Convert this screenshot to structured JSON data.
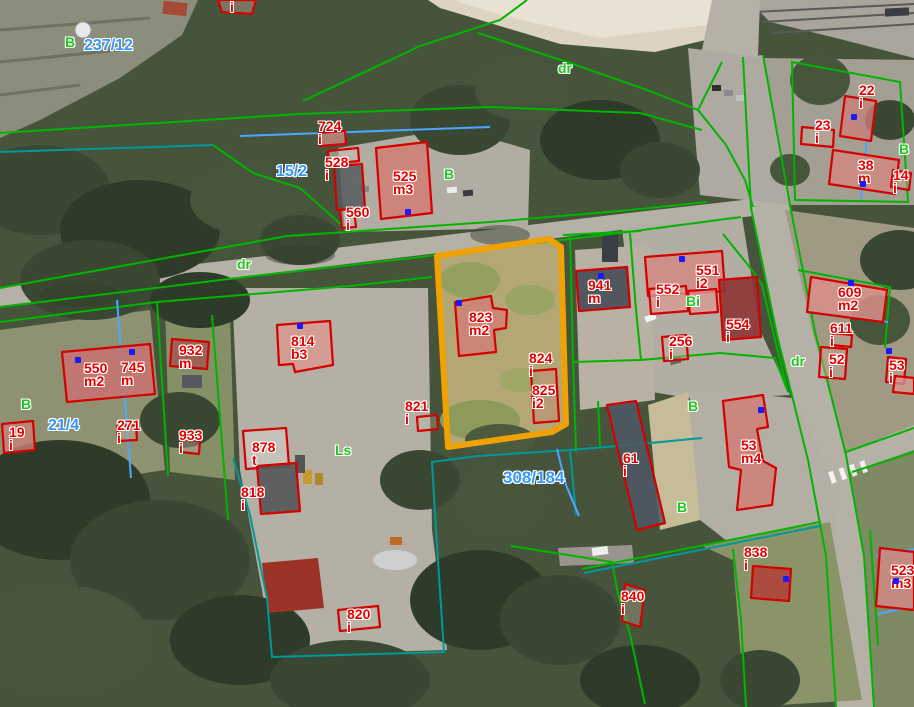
{
  "map": {
    "type": "aerial-cadastral-map",
    "colors": {
      "parcel_line_green": "#00b400",
      "parcel_line_teal": "#009898",
      "parcel_line_blue": "#4da6ff",
      "building_outline_red": "#d40000",
      "highlight_parcel_orange": "#f0a202",
      "label_red": "#e60000",
      "label_green": "#1fc71f",
      "label_blue": "#3399ff",
      "address_point_blue": "#1a1aff"
    },
    "labels": [
      {
        "lines": [
          "i"
        ],
        "x": 230,
        "y": 1,
        "color": "red"
      },
      {
        "lines": [
          "724",
          "i"
        ],
        "x": 318,
        "y": 120,
        "color": "red"
      },
      {
        "lines": [
          "528",
          "i"
        ],
        "x": 325,
        "y": 156,
        "color": "red"
      },
      {
        "lines": [
          "525",
          "m3"
        ],
        "x": 393,
        "y": 170,
        "color": "red"
      },
      {
        "lines": [
          "560",
          "i"
        ],
        "x": 346,
        "y": 206,
        "color": "red"
      },
      {
        "lines": [
          "823",
          "m2"
        ],
        "x": 469,
        "y": 311,
        "color": "red"
      },
      {
        "lines": [
          "824",
          "i"
        ],
        "x": 529,
        "y": 352,
        "color": "red"
      },
      {
        "lines": [
          "825",
          "i2"
        ],
        "x": 532,
        "y": 384,
        "color": "red"
      },
      {
        "lines": [
          "941",
          "m"
        ],
        "x": 588,
        "y": 279,
        "color": "red"
      },
      {
        "lines": [
          "551",
          "i2"
        ],
        "x": 696,
        "y": 264,
        "color": "red"
      },
      {
        "lines": [
          "552",
          "i"
        ],
        "x": 656,
        "y": 283,
        "color": "red"
      },
      {
        "lines": [
          "554",
          "i"
        ],
        "x": 726,
        "y": 318,
        "color": "red"
      },
      {
        "lines": [
          "256",
          "i"
        ],
        "x": 669,
        "y": 335,
        "color": "red"
      },
      {
        "lines": [
          "609",
          "m2"
        ],
        "x": 838,
        "y": 286,
        "color": "red"
      },
      {
        "lines": [
          "611",
          "i"
        ],
        "x": 830,
        "y": 322,
        "color": "red"
      },
      {
        "lines": [
          "52",
          "i"
        ],
        "x": 829,
        "y": 353,
        "color": "red"
      },
      {
        "lines": [
          "53",
          "i"
        ],
        "x": 889,
        "y": 359,
        "color": "red"
      },
      {
        "lines": [
          "22",
          "i"
        ],
        "x": 859,
        "y": 84,
        "color": "red"
      },
      {
        "lines": [
          "23",
          "i"
        ],
        "x": 815,
        "y": 119,
        "color": "red"
      },
      {
        "lines": [
          "38",
          "m"
        ],
        "x": 858,
        "y": 159,
        "color": "red"
      },
      {
        "lines": [
          "14",
          "i"
        ],
        "x": 893,
        "y": 169,
        "color": "red"
      },
      {
        "lines": [
          "550",
          "m2"
        ],
        "x": 84,
        "y": 362,
        "color": "red"
      },
      {
        "lines": [
          "745",
          "m"
        ],
        "x": 121,
        "y": 361,
        "color": "red"
      },
      {
        "lines": [
          "932",
          "m"
        ],
        "x": 179,
        "y": 344,
        "color": "red"
      },
      {
        "lines": [
          "814",
          "b3"
        ],
        "x": 291,
        "y": 335,
        "color": "red"
      },
      {
        "lines": [
          "19",
          "i"
        ],
        "x": 9,
        "y": 426,
        "color": "red"
      },
      {
        "lines": [
          "271",
          "i"
        ],
        "x": 117,
        "y": 419,
        "color": "red"
      },
      {
        "lines": [
          "933",
          "i"
        ],
        "x": 179,
        "y": 429,
        "color": "red"
      },
      {
        "lines": [
          "878",
          "t"
        ],
        "x": 252,
        "y": 441,
        "color": "red"
      },
      {
        "lines": [
          "818",
          "i"
        ],
        "x": 241,
        "y": 486,
        "color": "red"
      },
      {
        "lines": [
          "821",
          "i"
        ],
        "x": 405,
        "y": 400,
        "color": "red"
      },
      {
        "lines": [
          "820",
          "i"
        ],
        "x": 347,
        "y": 608,
        "color": "red"
      },
      {
        "lines": [
          "61",
          "i"
        ],
        "x": 623,
        "y": 452,
        "color": "red"
      },
      {
        "lines": [
          "53",
          "m4"
        ],
        "x": 741,
        "y": 439,
        "color": "red"
      },
      {
        "lines": [
          "838",
          "i"
        ],
        "x": 744,
        "y": 546,
        "color": "red"
      },
      {
        "lines": [
          "840",
          "i"
        ],
        "x": 621,
        "y": 590,
        "color": "red"
      },
      {
        "lines": [
          "523",
          "m3"
        ],
        "x": 891,
        "y": 564,
        "color": "red"
      },
      {
        "lines": [
          "237/12"
        ],
        "x": 84,
        "y": 38,
        "color": "blue"
      },
      {
        "lines": [
          "15/2"
        ],
        "x": 276,
        "y": 164,
        "color": "blue"
      },
      {
        "lines": [
          "21/4"
        ],
        "x": 48,
        "y": 418,
        "color": "blue"
      },
      {
        "lines": [
          "308/184"
        ],
        "x": 503,
        "y": 470,
        "color": "blue",
        "size": 17
      },
      {
        "lines": [
          "B"
        ],
        "x": 65,
        "y": 36,
        "color": "green"
      },
      {
        "lines": [
          "dr"
        ],
        "x": 558,
        "y": 62,
        "color": "green"
      },
      {
        "lines": [
          "B"
        ],
        "x": 444,
        "y": 168,
        "color": "green"
      },
      {
        "lines": [
          "dr"
        ],
        "x": 237,
        "y": 258,
        "color": "green"
      },
      {
        "lines": [
          "B"
        ],
        "x": 899,
        "y": 143,
        "color": "green"
      },
      {
        "lines": [
          "Bi"
        ],
        "x": 686,
        "y": 295,
        "color": "green"
      },
      {
        "lines": [
          "dr"
        ],
        "x": 791,
        "y": 355,
        "color": "green"
      },
      {
        "lines": [
          "B"
        ],
        "x": 21,
        "y": 398,
        "color": "green"
      },
      {
        "lines": [
          "Ls"
        ],
        "x": 335,
        "y": 444,
        "color": "green"
      },
      {
        "lines": [
          "B"
        ],
        "x": 688,
        "y": 400,
        "color": "green"
      },
      {
        "lines": [
          "B"
        ],
        "x": 677,
        "y": 501,
        "color": "green"
      }
    ],
    "address_points": [
      [
        408,
        212
      ],
      [
        459,
        303
      ],
      [
        300,
        326
      ],
      [
        78,
        360
      ],
      [
        132,
        352
      ],
      [
        682,
        259
      ],
      [
        601,
        276
      ],
      [
        851,
        283
      ],
      [
        854,
        117
      ],
      [
        863,
        184
      ],
      [
        761,
        410
      ],
      [
        786,
        579
      ],
      [
        896,
        581
      ],
      [
        889,
        351
      ]
    ]
  }
}
